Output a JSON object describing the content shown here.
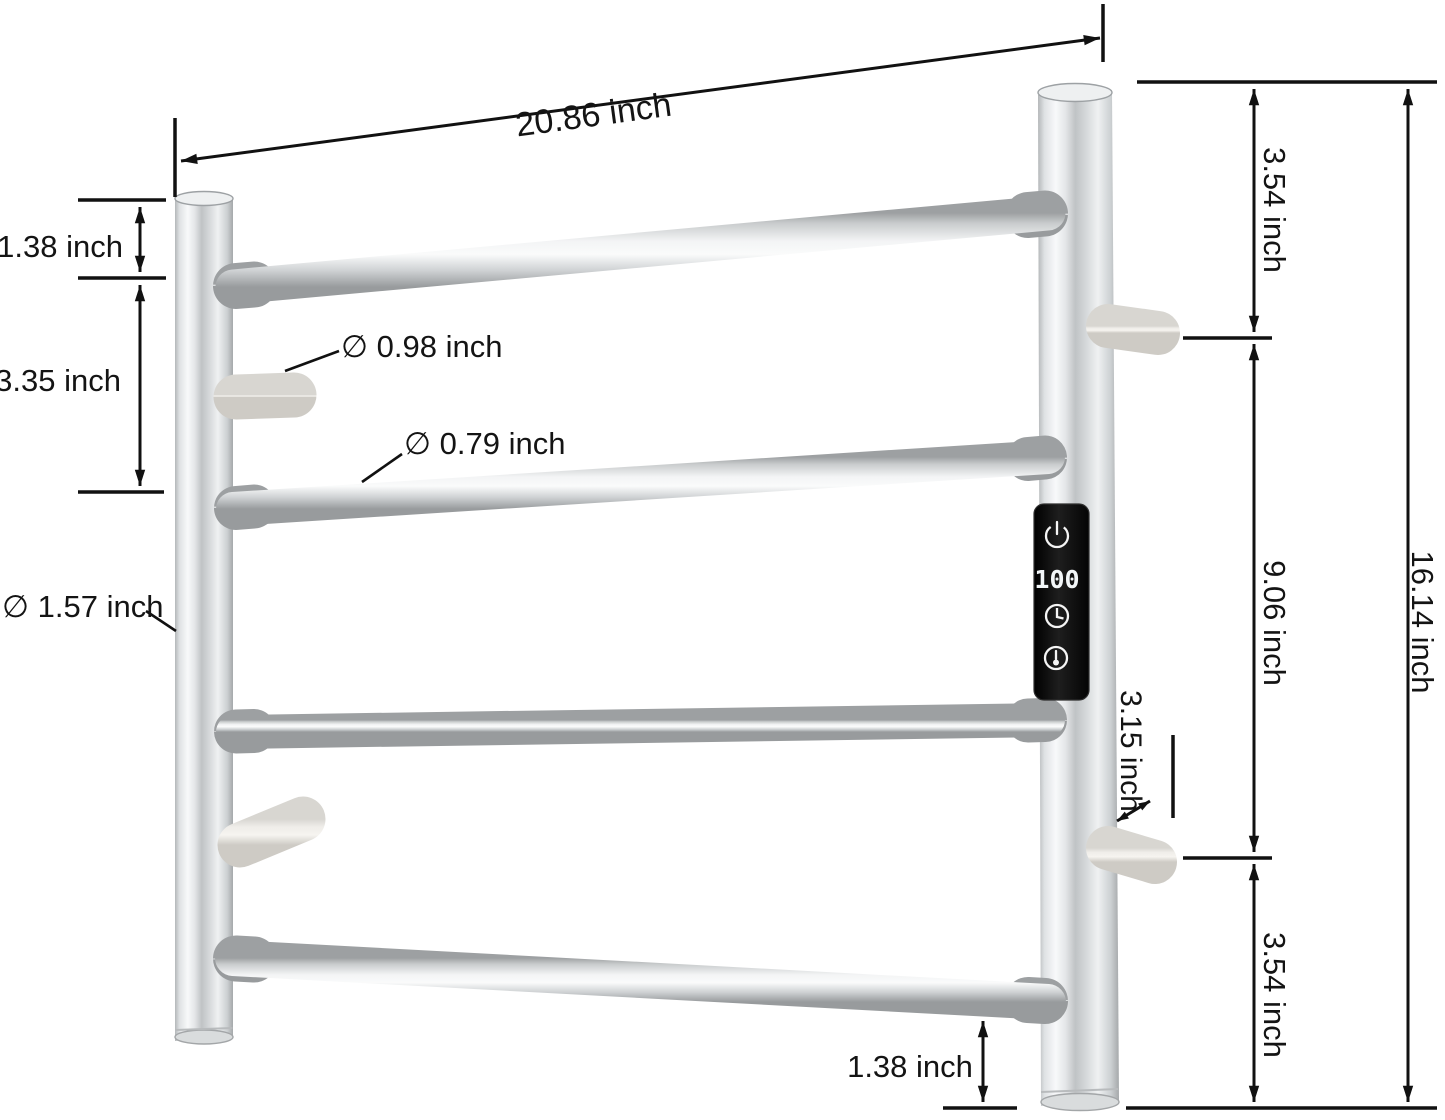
{
  "dimensions": {
    "top_width": "20.86 inch",
    "left_top_gap": "1.38 inch",
    "left_rung_gap": "3.35 inch",
    "hook_diameter": "∅ 0.98 inch",
    "bar_diameter": "∅ 0.79 inch",
    "post_diameter": "∅ 1.57 inch",
    "right_top_gap": "3.54 inch",
    "right_mid_span": "9.06 inch",
    "right_bottom_gap": "3.54 inch",
    "overall_height": "16.14 inch",
    "hook_offset": "3.15 inch",
    "bottom_gap": "1.38 inch"
  },
  "control_panel": {
    "display_value": "100",
    "icons": [
      "power-icon",
      "clock-icon",
      "thermometer-icon"
    ]
  },
  "colors": {
    "background": "#ffffff",
    "dimension_lines": "#111111",
    "label_text": "#141414",
    "panel_background": "#0b0b0b",
    "led_text": "#f2f6f8"
  }
}
